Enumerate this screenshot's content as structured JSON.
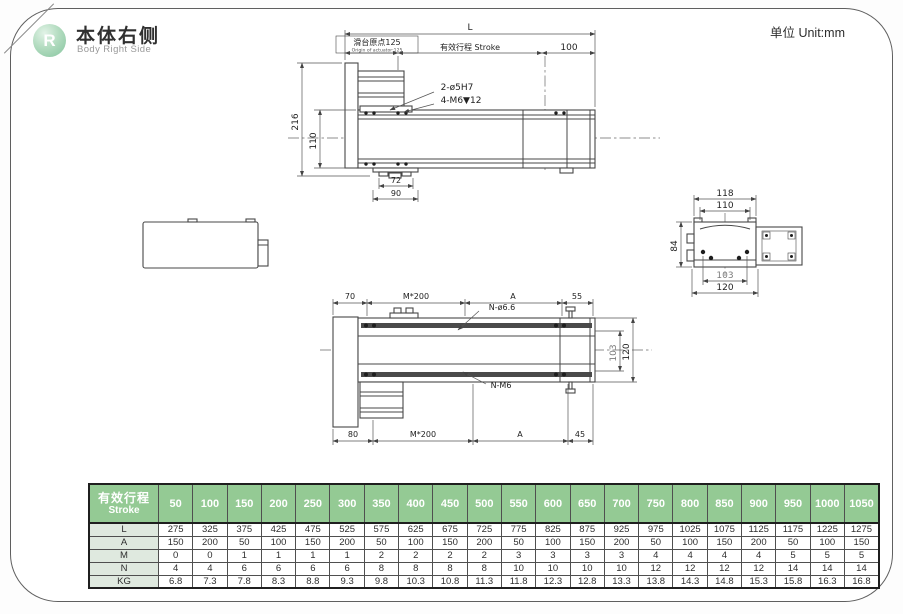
{
  "page": {
    "badge_letter": "R",
    "title_cn": "本体右侧",
    "title_en": "Body Right Side",
    "unit_label": "单位 Unit:mm"
  },
  "colors": {
    "accent_green": "#94ca94",
    "row_label_bg": "#dfe9df",
    "line": "#474747"
  },
  "side_view": {
    "dim_L": "L",
    "origin_cn": "滑台原点125",
    "origin_en": "Origin of actuator:125",
    "stroke_label": "有效行程 Stroke",
    "dim_100": "100",
    "dim_216": "216",
    "dim_110": "110",
    "dim_72": "72",
    "dim_90": "90",
    "callout_holes": "2-ø5H7",
    "callout_tap": "4-M6▼12"
  },
  "section_view": {
    "dim_118": "118",
    "dim_110": "110",
    "dim_84": "84",
    "dim_103": "103",
    "dim_120": "120"
  },
  "top_view": {
    "dim_70": "70",
    "dim_m200_top": "M*200",
    "dim_A_top": "A",
    "dim_55": "55",
    "dim_80": "80",
    "dim_m200_bottom": "M*200",
    "dim_A_bottom": "A",
    "dim_45": "45",
    "dim_103": "103",
    "dim_120": "120",
    "callout_hole": "N-ø6.6",
    "callout_tap": "N-M6"
  },
  "table": {
    "header_cn": "有效行程",
    "header_en": "Stroke",
    "strokes": [
      50,
      100,
      150,
      200,
      250,
      300,
      350,
      400,
      450,
      500,
      550,
      600,
      650,
      700,
      750,
      800,
      850,
      900,
      950,
      1000,
      1050
    ],
    "rows": [
      {
        "label": "L",
        "values": [
          275,
          325,
          375,
          425,
          475,
          525,
          575,
          625,
          675,
          725,
          775,
          825,
          875,
          925,
          975,
          1025,
          1075,
          1125,
          1175,
          1225,
          1275
        ]
      },
      {
        "label": "A",
        "values": [
          150,
          200,
          50,
          100,
          150,
          200,
          50,
          100,
          150,
          200,
          50,
          100,
          150,
          200,
          50,
          100,
          150,
          200,
          50,
          100,
          150
        ]
      },
      {
        "label": "M",
        "values": [
          0,
          0,
          1,
          1,
          1,
          1,
          2,
          2,
          2,
          2,
          3,
          3,
          3,
          3,
          4,
          4,
          4,
          4,
          5,
          5,
          5
        ]
      },
      {
        "label": "N",
        "values": [
          4,
          4,
          6,
          6,
          6,
          6,
          8,
          8,
          8,
          8,
          10,
          10,
          10,
          10,
          12,
          12,
          12,
          12,
          14,
          14,
          14
        ]
      },
      {
        "label": "KG",
        "values": [
          "6.8",
          "7.3",
          "7.8",
          "8.3",
          "8.8",
          "9.3",
          "9.8",
          "10.3",
          "10.8",
          "11.3",
          "11.8",
          "12.3",
          "12.8",
          "13.3",
          "13.8",
          "14.3",
          "14.8",
          "15.3",
          "15.8",
          "16.3",
          "16.8"
        ]
      }
    ]
  }
}
